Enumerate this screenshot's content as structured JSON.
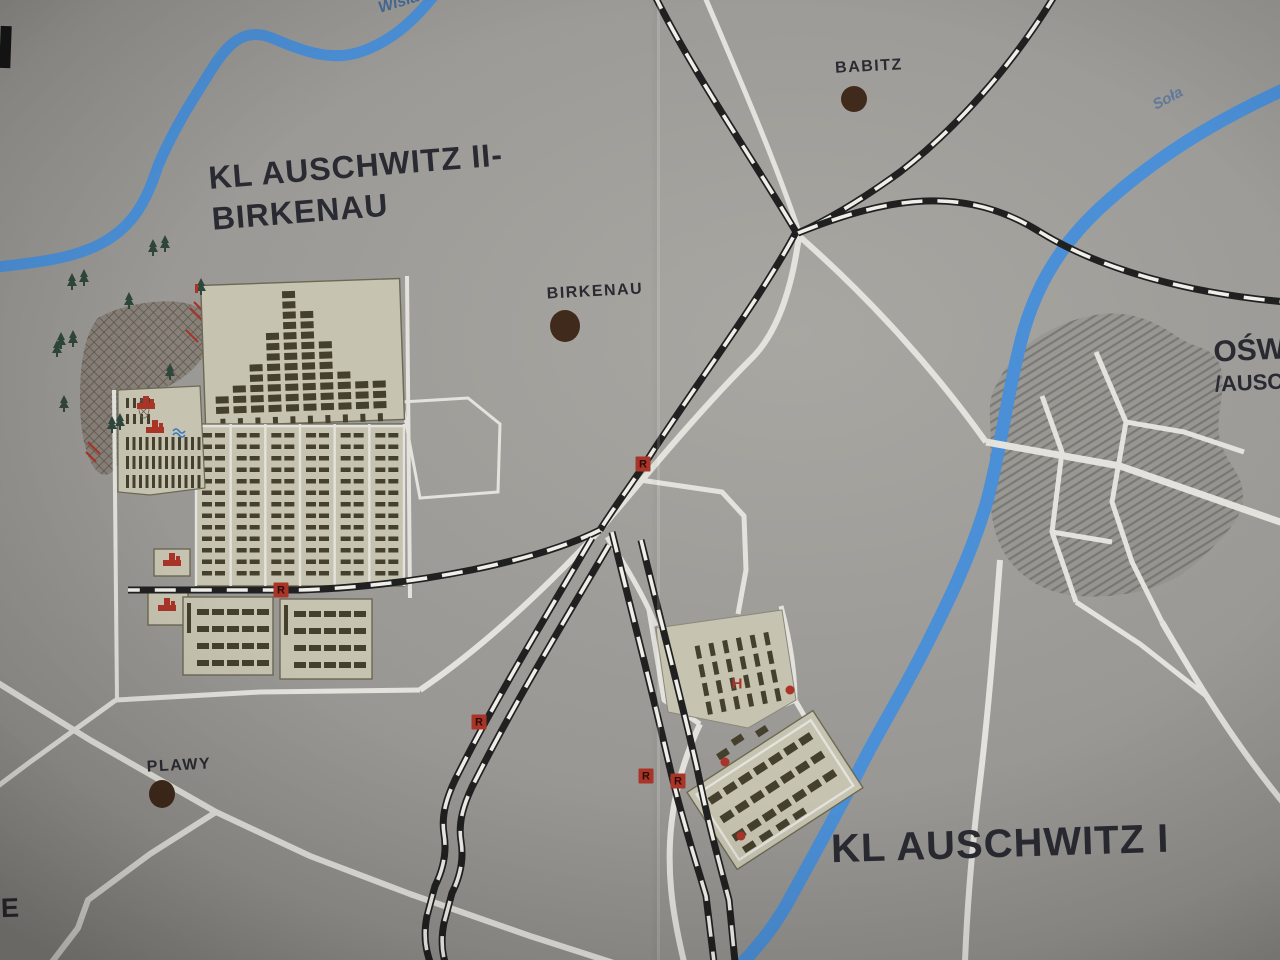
{
  "colors": {
    "background": "#9d9b97",
    "road": "#e3e2dd",
    "rail_black": "#202020",
    "rail_white": "#efeee9",
    "river": "#4b8fd6",
    "camp_fill": "#c6c4b0",
    "camp_border": "#6b6853",
    "barrack": "#45402d",
    "label_text": "#2a2a32",
    "town_dot": "#3f2a1b",
    "marker_red": "#a93428",
    "tree_green": "#2f463a",
    "woods_fill": "#867c6f",
    "woods_hatch": "#5f564b",
    "town_hatch": "#5a5a58"
  },
  "labels": {
    "camp2_line1": "KL AUSCHWITZ II-",
    "camp2_line2": "BIRKENAU",
    "camp1": "KL AUSCHWITZ I",
    "town_cut_line1": "OŚW",
    "town_cut_line2": "/AUSC",
    "river_top": "Wisła",
    "river_right": "Soła",
    "edge_letter": "E"
  },
  "towns": [
    {
      "name": "BABITZ",
      "label_x": 869,
      "label_y": 58,
      "dot_x": 854,
      "dot_y": 99,
      "dot_rx": 13,
      "dot_ry": 13
    },
    {
      "name": "BIRKENAU",
      "label_x": 595,
      "label_y": 283,
      "dot_x": 565,
      "dot_y": 326,
      "dot_rx": 15,
      "dot_ry": 16
    },
    {
      "name": "PLAWY",
      "label_x": 179,
      "label_y": 757,
      "dot_x": 162,
      "dot_y": 794,
      "dot_rx": 13,
      "dot_ry": 14
    }
  ],
  "rail_markers": [
    {
      "letter": "R",
      "x": 643,
      "y": 464
    },
    {
      "letter": "R",
      "x": 281,
      "y": 590
    },
    {
      "letter": "R",
      "x": 479,
      "y": 722
    },
    {
      "letter": "R",
      "x": 646,
      "y": 776
    },
    {
      "letter": "R",
      "x": 678,
      "y": 781
    }
  ],
  "site_markers": [
    {
      "letter": "H",
      "x": 737,
      "y": 684
    }
  ],
  "red_dots": [
    [
      790,
      690
    ],
    [
      725,
      762
    ],
    [
      741,
      836
    ]
  ],
  "memorial_icons": [
    [
      146,
      405
    ],
    [
      155,
      429
    ],
    [
      172,
      562
    ],
    [
      167,
      607
    ]
  ],
  "pond_icon": [
    179,
    431
  ],
  "trees": [
    [
      72,
      284
    ],
    [
      84,
      280
    ],
    [
      129,
      303
    ],
    [
      153,
      250
    ],
    [
      165,
      246
    ],
    [
      201,
      289
    ],
    [
      61,
      343
    ],
    [
      73,
      341
    ],
    [
      57,
      351
    ],
    [
      170,
      374
    ],
    [
      64,
      406
    ],
    [
      112,
      427
    ],
    [
      120,
      424
    ]
  ],
  "birkenau": {
    "mexico_columns": [
      2,
      3,
      5,
      8,
      12,
      10,
      7,
      4,
      3,
      3
    ],
    "bii_sectors": 6,
    "bii_rows": 13,
    "annex_bands": 3,
    "bottom_box_rows": 4,
    "bottom_box_cols": 5
  },
  "auschwitz1": {
    "upper_cols": 6,
    "upper_rows": 4,
    "lower_cols": 7,
    "lower_rows": 3
  }
}
